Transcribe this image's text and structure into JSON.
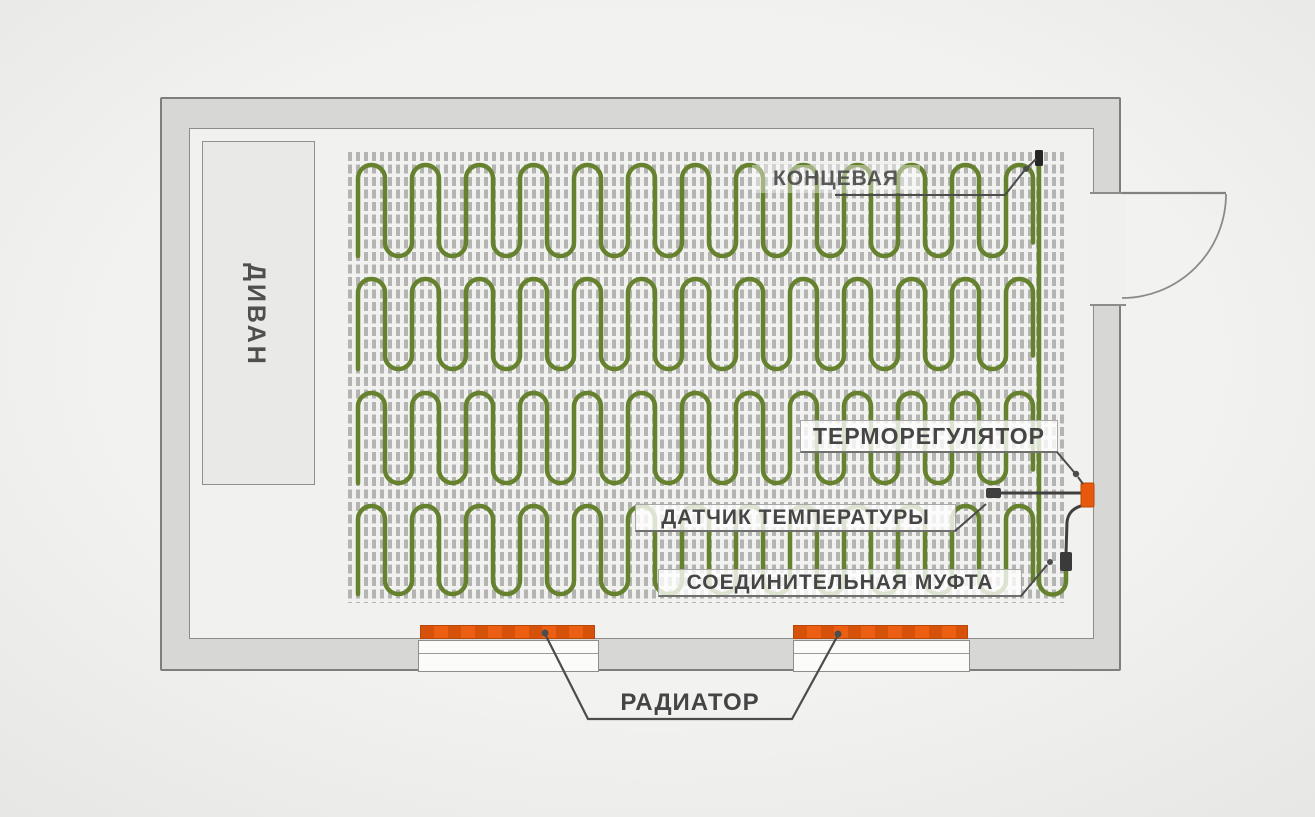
{
  "labels": {
    "sofa": "ДИВАН",
    "end_coupling": "КОНЦЕВАЯ",
    "thermostat": "ТЕРМОРЕГУЛЯТОР",
    "temp_sensor": "ДАТЧИК ТЕМПЕРАТУРЫ",
    "connection_coupling": "СОЕДИНИТЕЛЬНАЯ МУФТА",
    "radiator": "РАДИАТОР"
  },
  "colors": {
    "cable_green": "#66822f",
    "accent_orange": "#e8590e",
    "grid_gray": "#b4b4b2",
    "wall_fill": "#d7d7d5",
    "line_dark": "#4a4a4a"
  }
}
